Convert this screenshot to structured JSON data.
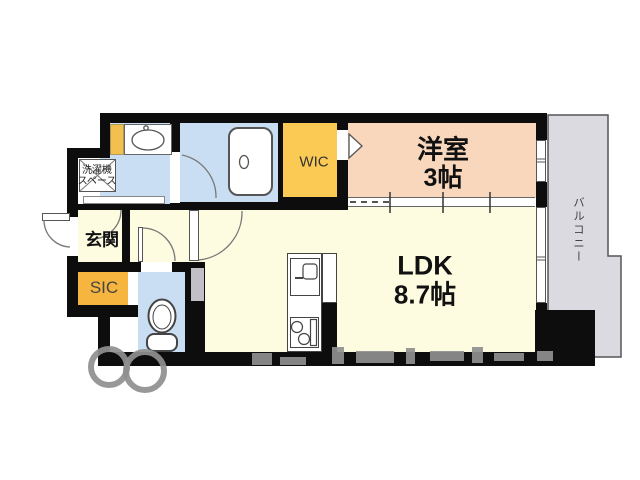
{
  "rooms": {
    "western": {
      "name": "洋室",
      "size": "3帖"
    },
    "ldk": {
      "name": "LDK",
      "size": "8.7帖"
    },
    "wic": {
      "name": "WIC"
    },
    "sic": {
      "name": "SIC"
    },
    "entrance": {
      "name": "玄関"
    },
    "balcony": {
      "name": "バルコニー"
    },
    "laundry": {
      "line1": "洗濯機",
      "line2": "スペース"
    }
  },
  "colors": {
    "wall": "#0d0d0d",
    "room_blue": "#c9def2",
    "room_cream": "#fdfbe0",
    "room_peach": "#f8d7bd",
    "wic_yellow": "#fbca55",
    "sic_yellow": "#f6b53e",
    "strip_yellow": "#f3c04f",
    "balcony_gray": "#dbdae0",
    "watermark_gray": "#8f8f8f"
  }
}
